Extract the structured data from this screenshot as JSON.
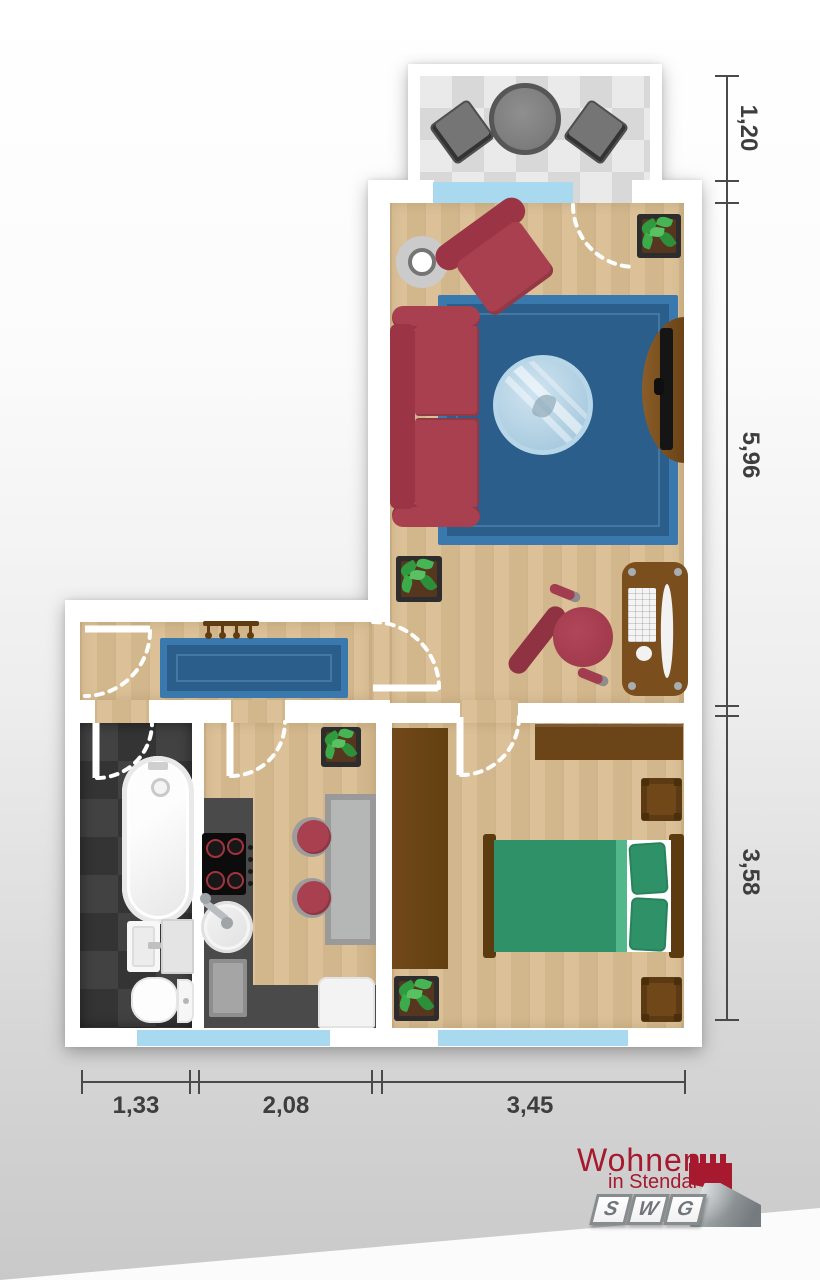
{
  "floorplan": {
    "type": "apartment-floor-plan-top-view",
    "dimensions_m": {
      "right": [
        "1,20",
        "5,96",
        "3,58"
      ],
      "bottom": [
        "1,33",
        "2,08",
        "3,45"
      ]
    },
    "rooms": [
      "balcony",
      "living-room",
      "hallway",
      "bathroom",
      "kitchen",
      "bedroom"
    ]
  },
  "logo": {
    "line1": "Wohnen",
    "line2": "in Stendal",
    "letters": [
      "S",
      "W",
      "G"
    ]
  },
  "colors": {
    "brand_red": "#a6192e",
    "wood_floor": "#d9bd92",
    "rug_blue": "#2b5e8b",
    "window_blue": "#a9d9ef",
    "bed_green": "#2f9168",
    "sofa_red": "#a8404f"
  }
}
